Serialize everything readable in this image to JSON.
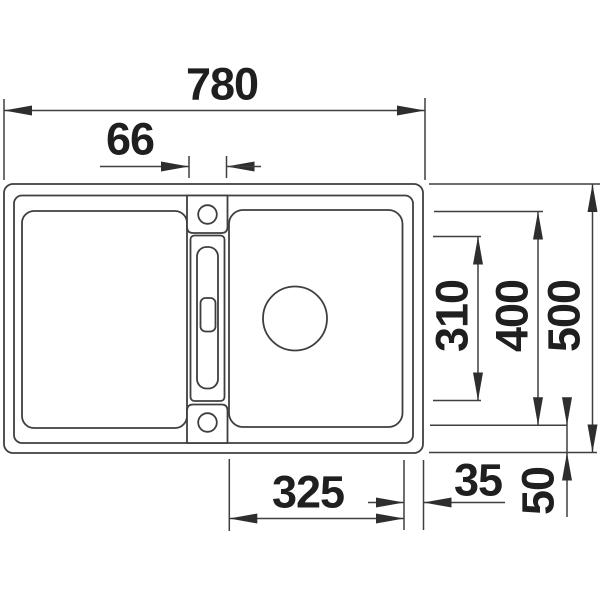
{
  "drawing": {
    "type": "sink-technical-drawing-top-view",
    "subject": "double-bowl kitchen sink with center divider, two tap holes and drain"
  },
  "colors": {
    "background": "#ffffff",
    "line": "#3f3f3f",
    "arrow": "#2e2e2e",
    "text": "#1f1f1f"
  },
  "dims": {
    "overall_width": "780",
    "divider_width": "66",
    "inner_depth": "310",
    "bowl_depth": "400",
    "overall_depth": "500",
    "bowl_width": "325",
    "side_offset": "35",
    "front_offset": "50"
  }
}
